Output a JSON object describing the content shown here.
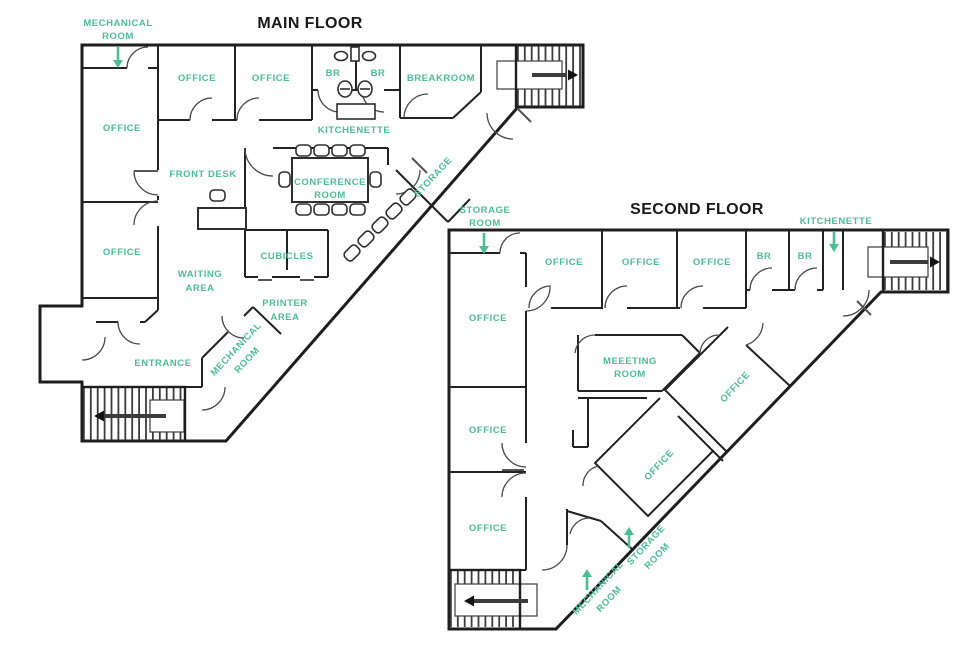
{
  "palette": {
    "accent_label_color": "#4CBD96",
    "wall_color": "#1e1e1e",
    "title_color": "#191919"
  },
  "main_floor": {
    "title": "MAIN FLOOR",
    "labels": {
      "mechanical_room_top": [
        "MECHANICAL",
        "ROOM"
      ],
      "office_left_upper": "OFFICE",
      "office_left_lower": "OFFICE",
      "office_top_1": "OFFICE",
      "office_top_2": "OFFICE",
      "br_left": "BR",
      "br_right": "BR",
      "kitchenette": "KITCHENETTE",
      "breakroom": "BREAKROOM",
      "front_desk": "FRONT DESK",
      "conference_room": [
        "CONFERENCE",
        "ROOM"
      ],
      "storage": "STORAGE",
      "cubicles": "CUBICLES",
      "waiting_area": [
        "WAITING",
        "AREA"
      ],
      "printer_area": [
        "PRINTER",
        "AREA"
      ],
      "mechanical_room_diag": [
        "MECHANICAL",
        "ROOM"
      ],
      "entrance": "ENTRANCE"
    }
  },
  "second_floor": {
    "title": "SECOND FLOOR",
    "labels": {
      "storage_room_top": [
        "STORAGE",
        "ROOM"
      ],
      "office_left_tall": "OFFICE",
      "office_top_1": "OFFICE",
      "office_top_2": "OFFICE",
      "office_top_3": "OFFICE",
      "br_left": "BR",
      "br_right": "BR",
      "kitchenette": "KITCHENETTE",
      "meeting_room": [
        "MEEETING",
        "ROOM"
      ],
      "office_diag_upper": "OFFICE",
      "office_diag_lower": "OFFICE",
      "office_left_middle": "OFFICE",
      "office_left_bottom": "OFFICE",
      "mechanical_room_diag": [
        "MECHANICAL",
        "ROOM"
      ],
      "storage_room_diag": [
        "STORAGE",
        "ROOM"
      ]
    }
  }
}
